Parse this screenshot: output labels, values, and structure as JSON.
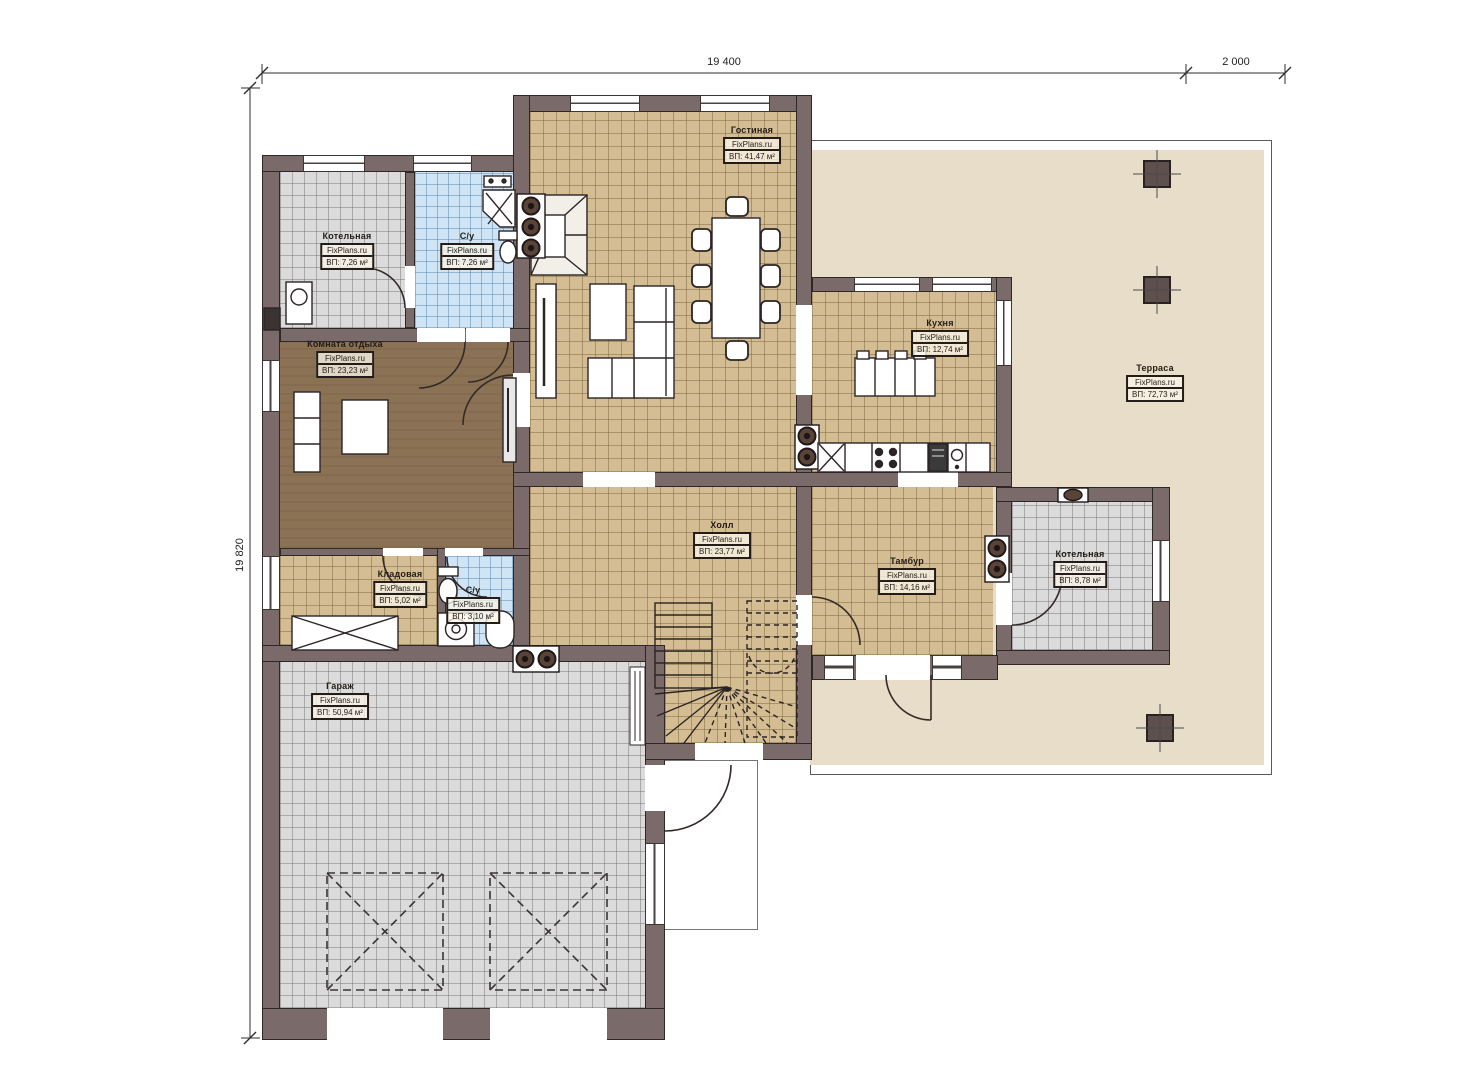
{
  "plan": {
    "dimensions": {
      "top_width": "19 400",
      "top_right_width": "2 000",
      "left_height": "19 820"
    }
  },
  "rooms": [
    {
      "name": "Гостиная",
      "brand": "FixPlans.ru",
      "area": "ВП: 41,47 м²"
    },
    {
      "name": "Котельная",
      "brand": "FixPlans.ru",
      "area": "ВП: 7,26 м²"
    },
    {
      "name": "С/у",
      "brand": "FixPlans.ru",
      "area": "ВП: 7,26 м²"
    },
    {
      "name": "Комната отдыха",
      "brand": "FixPlans.ru",
      "area": "ВП: 23,23 м²"
    },
    {
      "name": "Кухня",
      "brand": "FixPlans.ru",
      "area": "ВП: 12,74 м²"
    },
    {
      "name": "Терраса",
      "brand": "FixPlans.ru",
      "area": "ВП: 72,73 м²"
    },
    {
      "name": "Холл",
      "brand": "FixPlans.ru",
      "area": "ВП: 23,77 м²"
    },
    {
      "name": "Тамбур",
      "brand": "FixPlans.ru",
      "area": "ВП: 14,16 м²"
    },
    {
      "name": "Котельная",
      "brand": "FixPlans.ru",
      "area": "ВП: 8,78 м²"
    },
    {
      "name": "Кладовая",
      "brand": "FixPlans.ru",
      "area": "ВП: 5,02 м²"
    },
    {
      "name": "С/у",
      "brand": "FixPlans.ru",
      "area": "ВП: 3,10 м²"
    },
    {
      "name": "Гараж",
      "brand": "FixPlans.ru",
      "area": "ВП: 50,94 м²"
    }
  ]
}
